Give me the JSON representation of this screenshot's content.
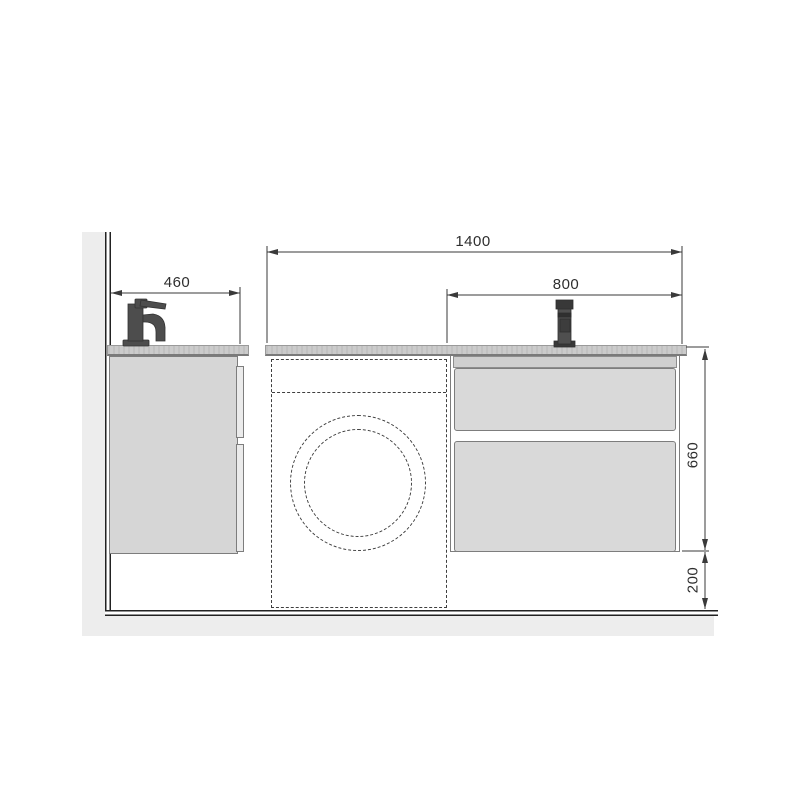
{
  "figure": {
    "type": "technical-drawing",
    "subject": "wall-hung vanity units with washing machine recess, front elevation",
    "dimensions": {
      "total_width": "1400",
      "right_section_width": "800",
      "left_vanity_width": "460",
      "cabinet_height": "660",
      "floor_clearance": "200"
    },
    "units_hint": "mm",
    "colors": {
      "cabinet_gray": "#d9d9d9",
      "counter_gray": "#cbcbcb",
      "wall_gray": "#ededed",
      "line_dark": "#3a3a3a",
      "faucet_dark": "#4d4d4d"
    },
    "icons": [
      {
        "name": "left-faucet-icon",
        "glyph": "side-view basin mixer silhouette"
      },
      {
        "name": "right-faucet-icon",
        "glyph": "front-view basin mixer silhouette"
      },
      {
        "name": "washing-machine-outline",
        "glyph": "dashed rectangle with dashed door circles"
      }
    ]
  }
}
